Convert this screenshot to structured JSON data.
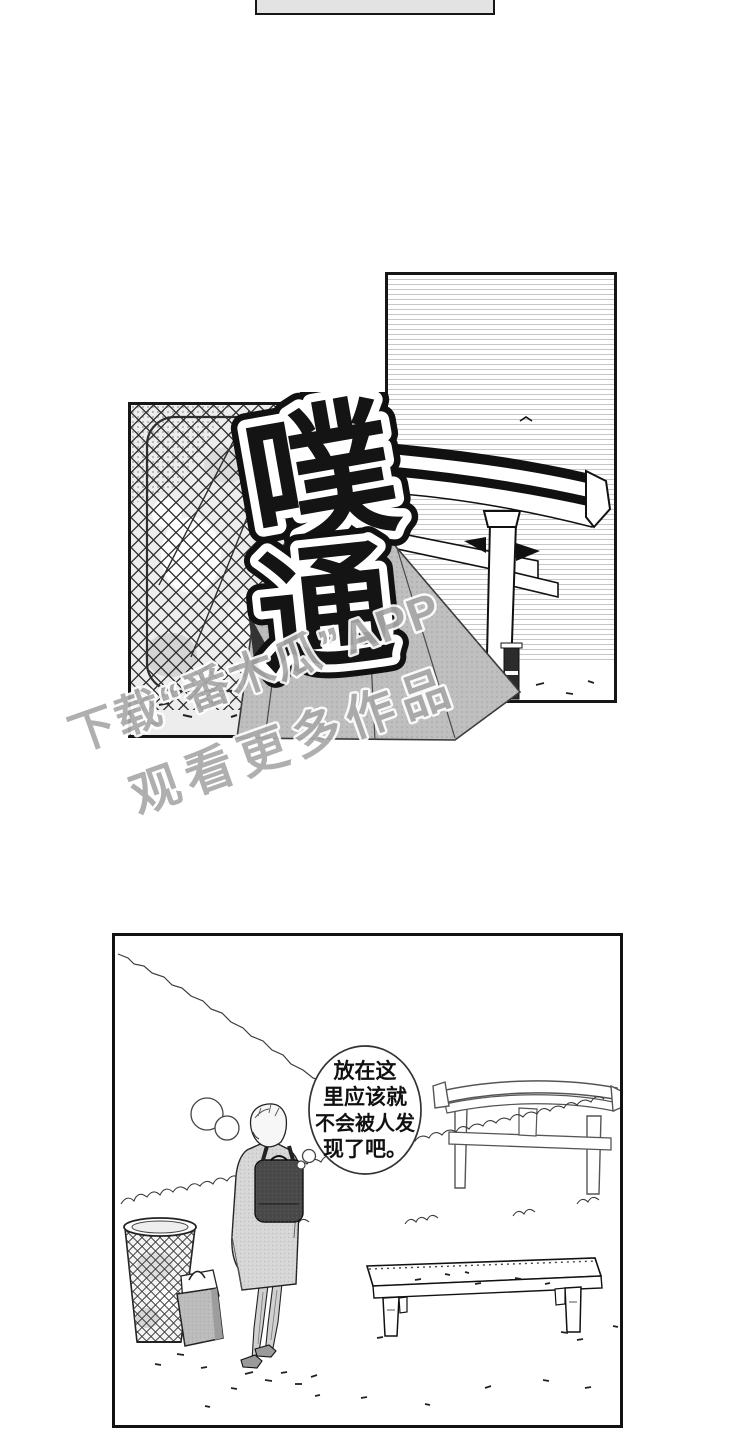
{
  "comic": {
    "sfx": {
      "char_top": "噗",
      "char_bottom": "通",
      "meaning": "plop-thud sound effect"
    },
    "watermark": {
      "line1": "下载“番木瓜”APP",
      "line2": "观看更多作品"
    },
    "bubble": {
      "line1": "放在这",
      "line2": "里应该就",
      "line3": "不会被人发",
      "line4": "现了吧。",
      "full_text": "放在这里应该就不会被人发现了吧。"
    }
  },
  "colors": {
    "ink": "#1a1a1a",
    "sky_line_gray": "#c6c6c6",
    "tone_gray": "#bfbfbf",
    "watermark_gray": "#a9a9a9",
    "backpack_dark": "#484848"
  }
}
